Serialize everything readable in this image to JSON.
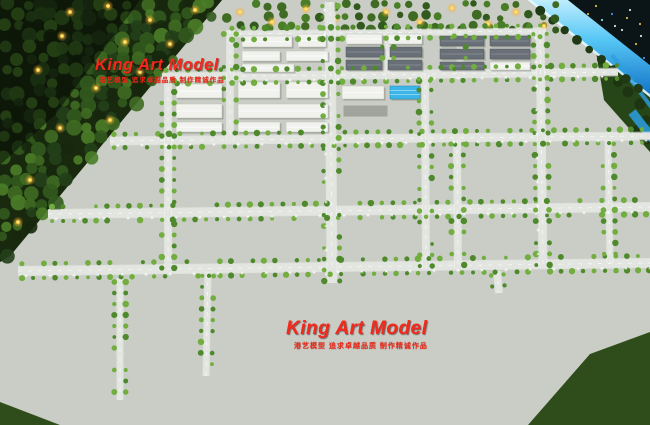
{
  "scene": {
    "type": "photo-of-architectural-scale-model",
    "subject": "aerial view of illuminated industrial-park planning model"
  },
  "watermarks": {
    "primary": {
      "title": "King Art Model",
      "tagline": "港艺模型 追求卓越品质 制作精诚作品"
    },
    "secondary": {
      "title": "King Art Model",
      "tagline": "港艺模型 追求卓越品质 制作精诚作品"
    }
  },
  "colors": {
    "base_green": "#2f4d1a",
    "forest_dark": "#18290e",
    "plane": "#c9cdc5",
    "road": "#e2e5e0",
    "road_glow": "#9fdcff",
    "river_bright": "#45c0f5",
    "river_deep": "#0f6fc4",
    "tree_road": "#4e8a2c",
    "tree_road_alt": "#71ad3f",
    "building_white": "#f1f2ee",
    "building_stroke": "#bcc0b8",
    "roof_gray": "#686f77",
    "roof_blue": "#2f9ed6",
    "roof_red": "#bb3028",
    "basin_blue": "#1d3f86",
    "pool_cyan": "#35b9e2",
    "container_orange": "#e07c1e",
    "container_blue": "#2f55b0",
    "crane_red": "#d63226",
    "rail_dark": "#26292c",
    "lawn_bright": "#3f8d1c",
    "park_green": "#35641b",
    "toll_glow": "#f09a3c",
    "watermark_red": "#f5281c",
    "light_warm": "#ffc03a",
    "dark_corner": "#0b1518"
  }
}
